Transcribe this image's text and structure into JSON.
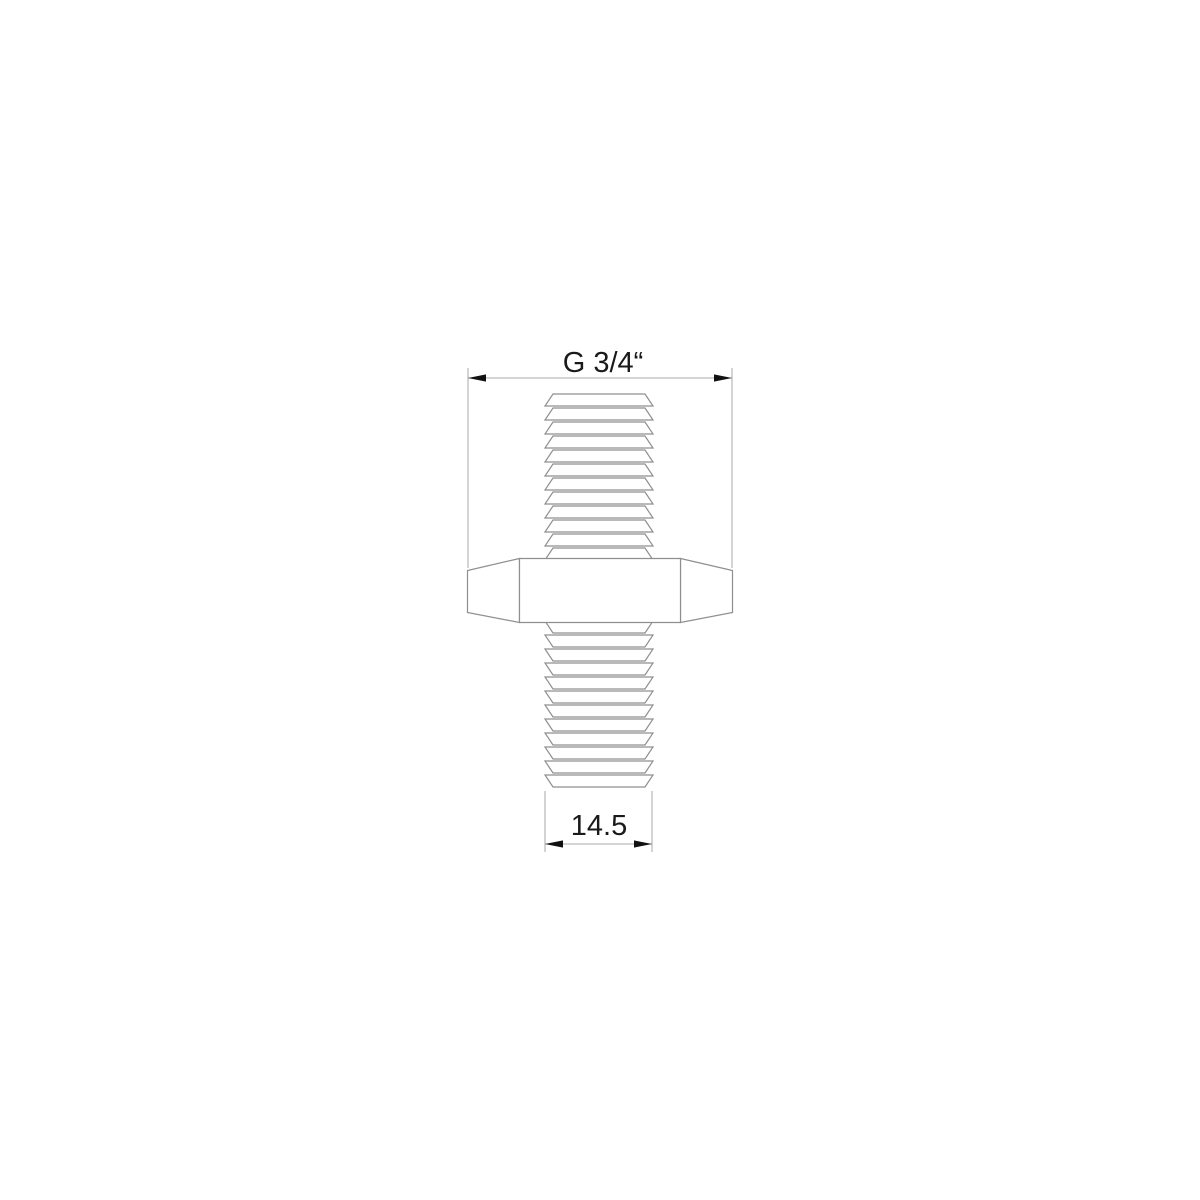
{
  "drawing": {
    "background": "#ffffff",
    "part_line_color": "#8f8f8f",
    "dim_line_color": "#a9a9a9",
    "arrow_color": "#111111",
    "text_color": "#1a1a1a",
    "font_size": 29,
    "part": {
      "center_x": 599,
      "upper_thread": {
        "first_band_top_y": 394,
        "band_count": 12,
        "pitch": 14,
        "band_height": 12,
        "narrow_width": 92,
        "wide_width": 108,
        "narrow_edge": "top"
      },
      "lower_thread": {
        "first_band_top_y": 621,
        "band_count": 12,
        "pitch": 14,
        "band_height": 12,
        "narrow_width": 92,
        "wide_width": 108,
        "narrow_edge": "bottom"
      },
      "hex_body": {
        "face_x1": 519.5,
        "face_x2": 680.5,
        "top_y": 558.5,
        "bottom_y": 622.5,
        "end_x1": 467.5,
        "end_x2": 732.5,
        "end_top_y": 570.5,
        "end_bottom_y": 612.5
      }
    },
    "dimensions": {
      "top": {
        "label": "G 3/4“",
        "line_y": 378,
        "x1": 468,
        "x2": 732,
        "ext_y1": 368,
        "ext_y2": 568,
        "text_x": 603,
        "text_baseline_y": 372
      },
      "bottom": {
        "label": "14.5",
        "line_y": 844,
        "x1": 545,
        "x2": 652,
        "ext_y1": 791,
        "ext_y2": 852,
        "text_x": 599,
        "text_baseline_y": 835
      }
    },
    "arrow": {
      "length": 18,
      "half_width": 3.6
    }
  }
}
